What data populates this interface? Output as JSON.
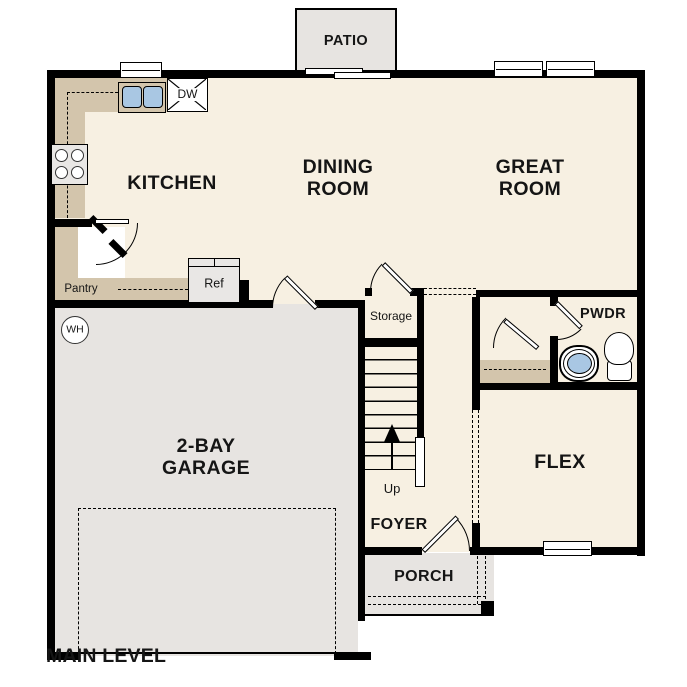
{
  "colors": {
    "floor": "#f7f0e2",
    "hard": "#e7e4e1",
    "counter": "#d3c5ac",
    "blue": "#a9c7e3",
    "wall": "#000000",
    "fixture": "#e9e7e5"
  },
  "plan": {
    "title": "MAIN LEVEL",
    "rooms": {
      "patio": "PATIO",
      "kitchen": "KITCHEN",
      "dining": "DINING ROOM",
      "great": "GREAT ROOM",
      "garage": "2-BAY GARAGE",
      "flex": "FLEX",
      "pwdr": "PWDR",
      "foyer": "FOYER",
      "porch": "PORCH",
      "storage": "Storage",
      "pantry": "Pantry"
    },
    "fixtures": {
      "ref": "Ref",
      "dishwasher": "DW",
      "water_heater": "WH",
      "stairs_up": "Up"
    }
  }
}
